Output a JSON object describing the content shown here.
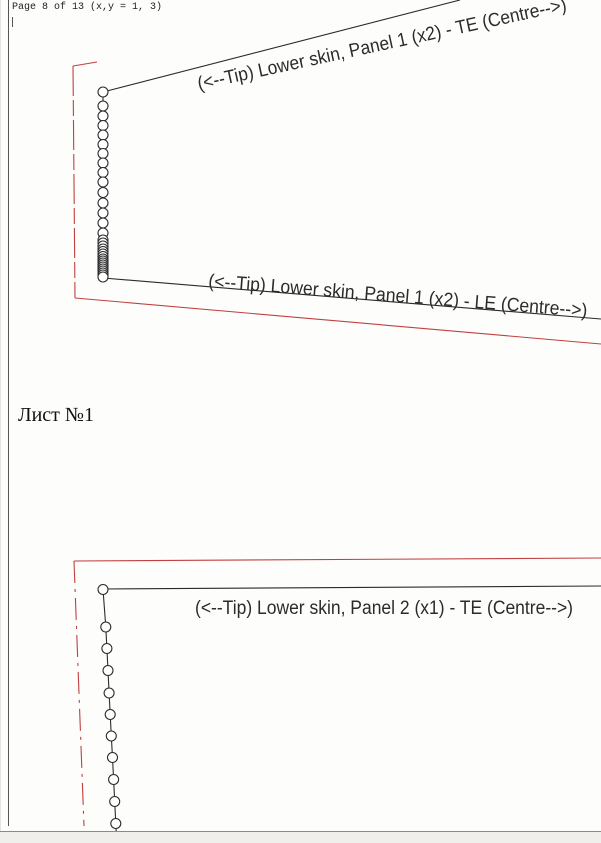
{
  "window": {
    "header_text": "Page 8 of 13 (x,y = 1, 3)",
    "sheet_label": "Лист №1",
    "chrome": {
      "bottom_band_color": "#f0efeb",
      "bottom_line_color": "#8a8a8a"
    }
  },
  "colors": {
    "black": "#2b2b2b",
    "border_gray": "#555555",
    "red": "#c04040",
    "circle_fill": "#ffffff"
  },
  "drawing": {
    "width": 601,
    "height": 843,
    "page_border": {
      "x": 8.5,
      "y1": 0,
      "y2": 826,
      "tick_x": 12.5,
      "tick_y1": 17,
      "tick_y2": 27
    },
    "black_lines": [
      [
        103,
        92,
        460,
        0
      ],
      [
        103,
        278,
        601,
        319
      ],
      [
        103,
        589,
        601,
        586
      ]
    ],
    "connector_polylines": [
      [
        [
          103,
          92
        ],
        [
          103,
          278
        ]
      ],
      [
        [
          103,
          589.5
        ],
        [
          105.8,
          627
        ],
        [
          106.9,
          648.5
        ],
        [
          108,
          670.5
        ],
        [
          109.1,
          693
        ],
        [
          110.2,
          714.5
        ],
        [
          111.3,
          736
        ],
        [
          112.5,
          757.5
        ],
        [
          113.6,
          779.5
        ],
        [
          114.7,
          801.5
        ],
        [
          115.8,
          823.5
        ],
        [
          116.3,
          834
        ]
      ]
    ],
    "red_polylines": [
      {
        "points": [
          [
            97,
            62
          ],
          [
            73,
            66
          ]
        ],
        "dashed": false
      },
      {
        "points": [
          [
            73,
            66
          ],
          [
            75,
            298
          ]
        ],
        "dashed": true
      },
      {
        "points": [
          [
            75,
            298
          ],
          [
            601,
            344
          ]
        ],
        "dashed": false
      },
      {
        "points": [
          [
            601,
            558
          ],
          [
            74,
            561
          ]
        ],
        "dashed": false
      },
      {
        "points": [
          [
            74,
            561
          ],
          [
            84,
            826
          ]
        ],
        "dashed": true
      }
    ],
    "circle_chains": [
      {
        "r": 5,
        "centers": [
          [
            103,
            92
          ],
          [
            103,
            106
          ],
          [
            103,
            116
          ],
          [
            103,
            125.5
          ],
          [
            103,
            135
          ],
          [
            103,
            144.5
          ],
          [
            103,
            153.5
          ],
          [
            103,
            163
          ],
          [
            103,
            172.5
          ],
          [
            103,
            182
          ],
          [
            103,
            192.5
          ],
          [
            103,
            203
          ],
          [
            103,
            213
          ],
          [
            103,
            223
          ],
          [
            103,
            233
          ],
          [
            103,
            240
          ],
          [
            103,
            243
          ],
          [
            103,
            246
          ],
          [
            103,
            249
          ],
          [
            103,
            251.5
          ],
          [
            103,
            254
          ],
          [
            103,
            256.5
          ],
          [
            103,
            259
          ],
          [
            103,
            261
          ],
          [
            103,
            263
          ],
          [
            103,
            265
          ],
          [
            103,
            267
          ],
          [
            103,
            269
          ],
          [
            103,
            271
          ],
          [
            103,
            273
          ],
          [
            103,
            275
          ],
          [
            103,
            277
          ]
        ]
      },
      {
        "r": 5,
        "centers": [
          [
            103,
            589.5
          ],
          [
            105.8,
            627
          ],
          [
            106.9,
            648.5
          ],
          [
            108,
            670.5
          ],
          [
            109.1,
            693
          ],
          [
            110.2,
            714.5
          ],
          [
            111.3,
            736
          ],
          [
            112.5,
            757.5
          ],
          [
            113.6,
            779.5
          ],
          [
            114.7,
            801.5
          ],
          [
            115.8,
            823.5
          ]
        ]
      }
    ],
    "labels": [
      {
        "text": "(<--Tip)  Lower skin, Panel 1 (x2) - TE  (Centre-->)",
        "x": 199,
        "y": 90,
        "angle": -12.2,
        "length": 377
      },
      {
        "text": "(<--Tip)  Lower skin, Panel 1 (x2) - LE  (Centre-->)",
        "x": 208,
        "y": 287,
        "angle": 4.5,
        "length": 380
      },
      {
        "text": "(<--Tip)  Lower skin, Panel 2 (x1) - TE  (Centre-->)",
        "x": 195,
        "y": 614,
        "angle": 0,
        "length": 378
      }
    ],
    "label_font_size": 19,
    "dash_patterns": {
      "panel1_vertical": "30 4 16 4",
      "panel2_vertical": "22 6 3 6"
    }
  }
}
